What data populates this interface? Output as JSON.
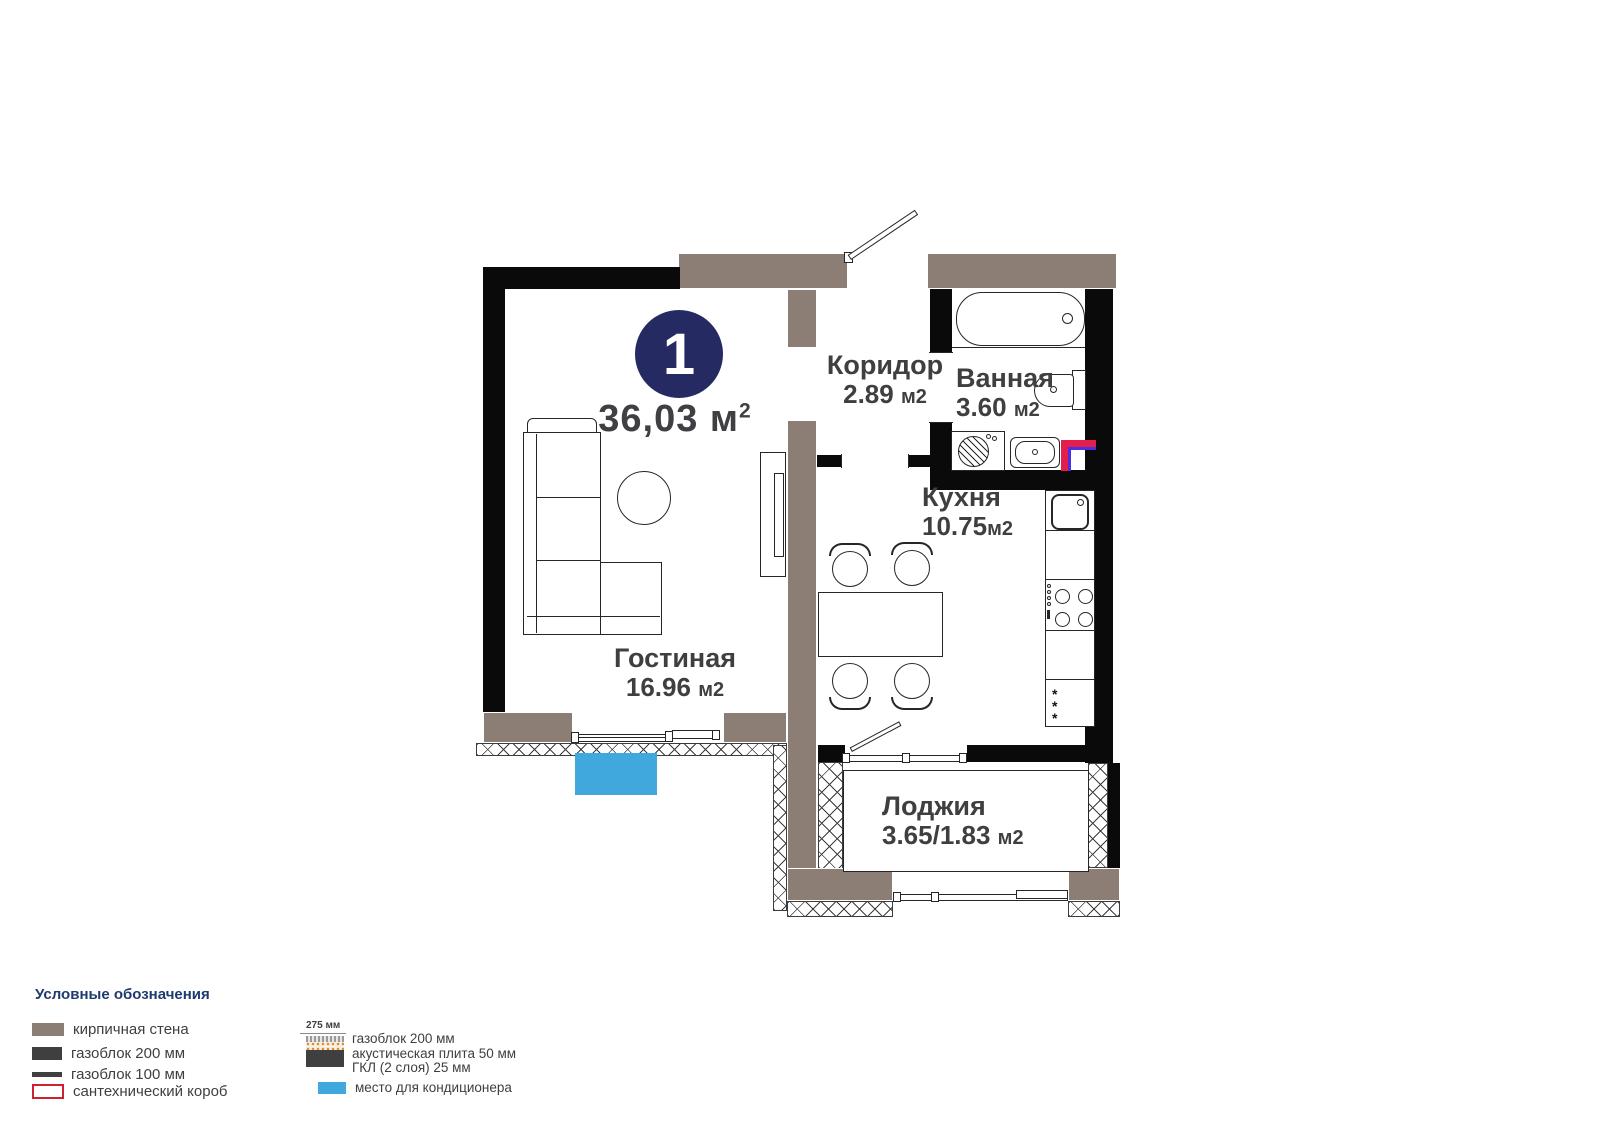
{
  "plan": {
    "badge": "1",
    "total_area": "36,03 м",
    "total_area_sup": "2",
    "rooms": [
      {
        "name": "Гостиная",
        "area": "16.96",
        "unit": "м2"
      },
      {
        "name": "Коридор",
        "area": "2.89",
        "unit": "м2"
      },
      {
        "name": "Ванная",
        "area": "3.60",
        "unit": "м2"
      },
      {
        "name": "Кухня",
        "area": "10.75",
        "unit": "м2"
      },
      {
        "name": "Лоджия",
        "area": "3.65/1.83",
        "unit": "м2"
      }
    ],
    "fridge_marker": "*\n*\n*"
  },
  "legend": {
    "title": "Условные обозначения",
    "items": [
      {
        "label": "кирпичная стена",
        "swatch": "brick-wall"
      },
      {
        "label": "газоблок 200 мм",
        "swatch": "gasblock-200"
      },
      {
        "label": "газоблок 100 мм",
        "swatch": "gasblock-100"
      },
      {
        "label": "сантехнический короб",
        "swatch": "plumbing-box"
      }
    ],
    "layered_wall": {
      "dimension": "275 мм",
      "lines": [
        "газоблок 200 мм",
        "акустическая плита 50 мм",
        "ГКЛ (2 слоя) 25 мм"
      ]
    },
    "ac_label": "место для кондиционера"
  },
  "colors": {
    "brick": "#8c7e74",
    "wall_black": "#0a0a0a",
    "badge_navy": "#262a63",
    "ac_blue": "#41a8dd",
    "plumbing_red": "#e31e4d",
    "plumbing_blue": "#4b2fe0",
    "legend_title_navy": "#1e3a6e",
    "text_gray": "#3f3f41"
  }
}
